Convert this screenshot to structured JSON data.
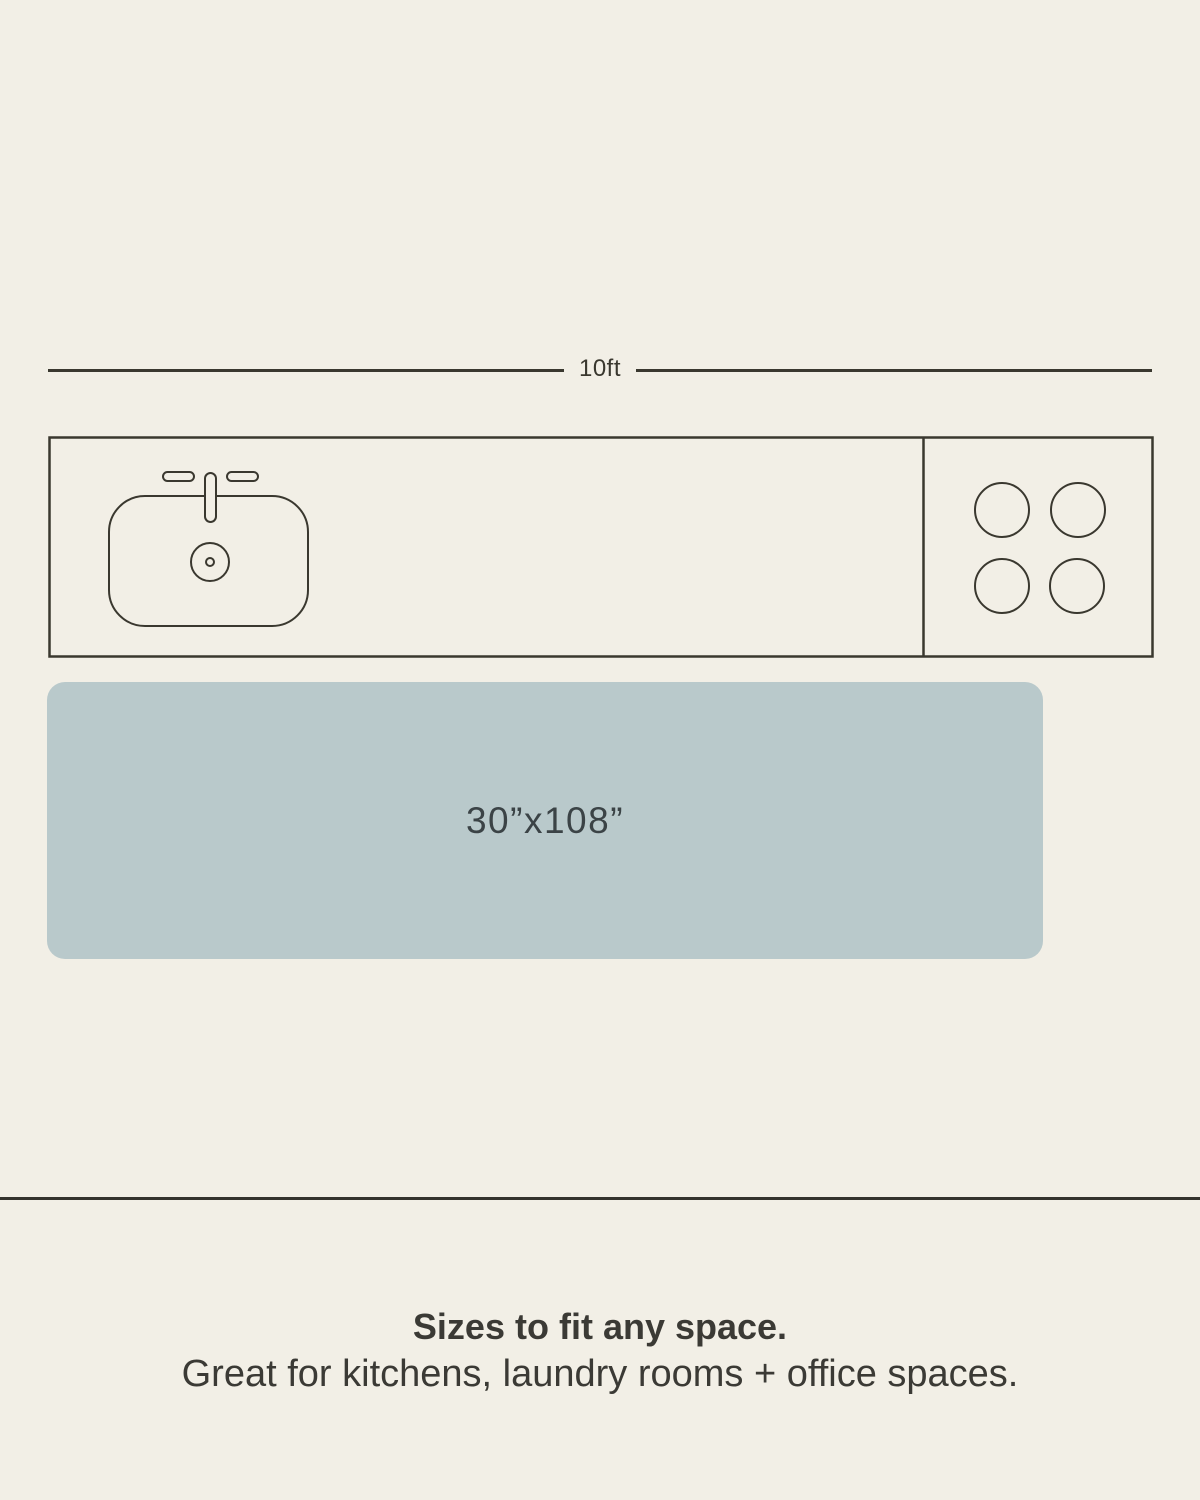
{
  "page": {
    "background_color": "#f2efe6"
  },
  "measurement": {
    "label": "10ft"
  },
  "counter_diagram": {
    "stroke_color": "#3a382f",
    "icons": [
      "sink-icon",
      "faucet-icon",
      "drain-icon",
      "stove-burners-icon"
    ]
  },
  "rug": {
    "size_label": "30”x108”",
    "fill_color": "#b9c9cb",
    "label_color": "#3b4346"
  },
  "divider": {
    "color": "#34332d"
  },
  "caption": {
    "headline": "Sizes to fit any space.",
    "subtext": "Great for kitchens, laundry rooms + office spaces.",
    "text_color": "#3b3a35"
  }
}
